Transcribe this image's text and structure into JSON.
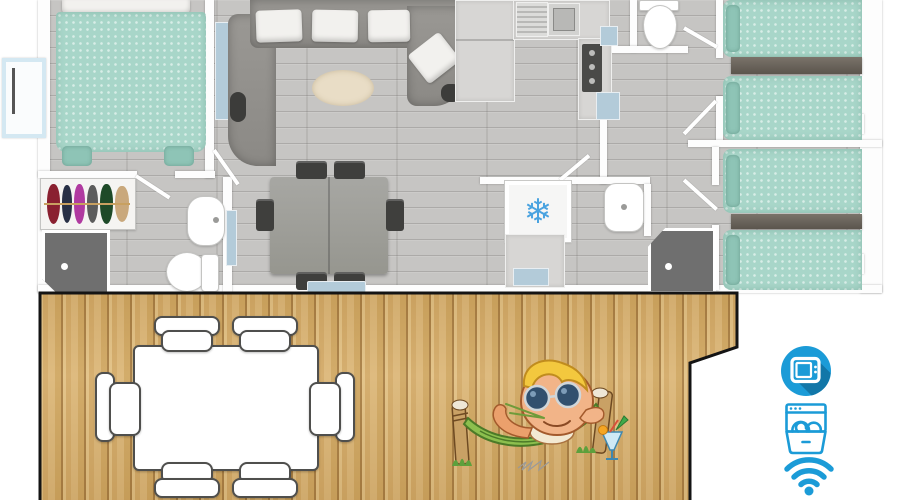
{
  "scene": {
    "description": "Top-view 3D floor plan of a holiday mobile home with a wooden terrace",
    "sections": [
      "floor-plan",
      "terrace",
      "amenity-icons"
    ]
  },
  "floorplan": {
    "rooms": [
      {
        "name": "master-bedroom",
        "furniture": [
          "double-bed",
          "wardrobe"
        ]
      },
      {
        "name": "bathroom-1",
        "furniture": [
          "shower",
          "washbasin",
          "toilet"
        ]
      },
      {
        "name": "living-room",
        "furniture": [
          "corner-sofa",
          "tv-cabinet",
          "rug",
          "dining-table",
          "six-chairs"
        ]
      },
      {
        "name": "kitchen",
        "furniture": [
          "fridge",
          "sink",
          "hob"
        ]
      },
      {
        "name": "wc",
        "furniture": [
          "toilet"
        ]
      },
      {
        "name": "bathroom-2",
        "furniture": [
          "air-conditioning-unit",
          "washbasin",
          "shower",
          "utility-unit"
        ]
      },
      {
        "name": "bedroom-2",
        "furniture": [
          "single-bed",
          "single-bed",
          "headboard-shelf"
        ]
      },
      {
        "name": "bedroom-3",
        "furniture": [
          "single-bed",
          "single-bed",
          "headboard-shelf"
        ]
      }
    ],
    "entrance": "left-side-door"
  },
  "terrace": {
    "furniture": [
      "outdoor-dining-table",
      "six-outdoor-chairs"
    ],
    "mascot": "elf-relaxing-in-hammock-with-cocktail"
  },
  "amenities": {
    "icons": [
      {
        "name": "tv-icon"
      },
      {
        "name": "dishwasher-icon"
      },
      {
        "name": "wifi-icon"
      }
    ]
  },
  "glyphs": {
    "snowflake": "❄"
  },
  "colors": {
    "icon_blue": "#1b9bd7",
    "icon_blue_shadow": "#1277a8",
    "bed_teal": "#a8d6c9",
    "sofa_gray": "#95938f",
    "floor_gray": "#c6c5c3",
    "deck_wood": "#d9b470",
    "wall_white": "#ffffff",
    "fixture_dark": "#6f6f6f",
    "accent_light_blue": "#b3cbd9",
    "snowflake_blue": "#4aa3e0"
  }
}
